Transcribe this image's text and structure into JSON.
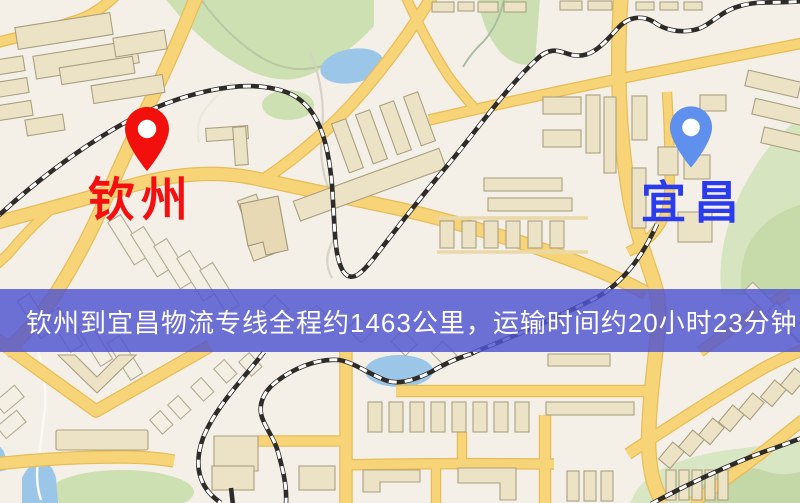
{
  "map": {
    "origin": {
      "name": "钦州",
      "pin_color": "#f2100c",
      "label_color": "#f50f0f"
    },
    "destination": {
      "name": "宜昌",
      "pin_color": "#6090ee",
      "label_color": "#2b3cee"
    }
  },
  "banner": {
    "text": "钦州到宜昌物流专线全程约1463公里，运输时间约20小时23分钟.",
    "background_color": "#5054cf",
    "text_color": "#ffffff"
  },
  "route_summary": {
    "origin": "钦州",
    "destination": "宜昌",
    "service_type": "物流专线",
    "distance_text": "全程约1463公里",
    "duration_text": "运输时间约20小时23分钟"
  }
}
